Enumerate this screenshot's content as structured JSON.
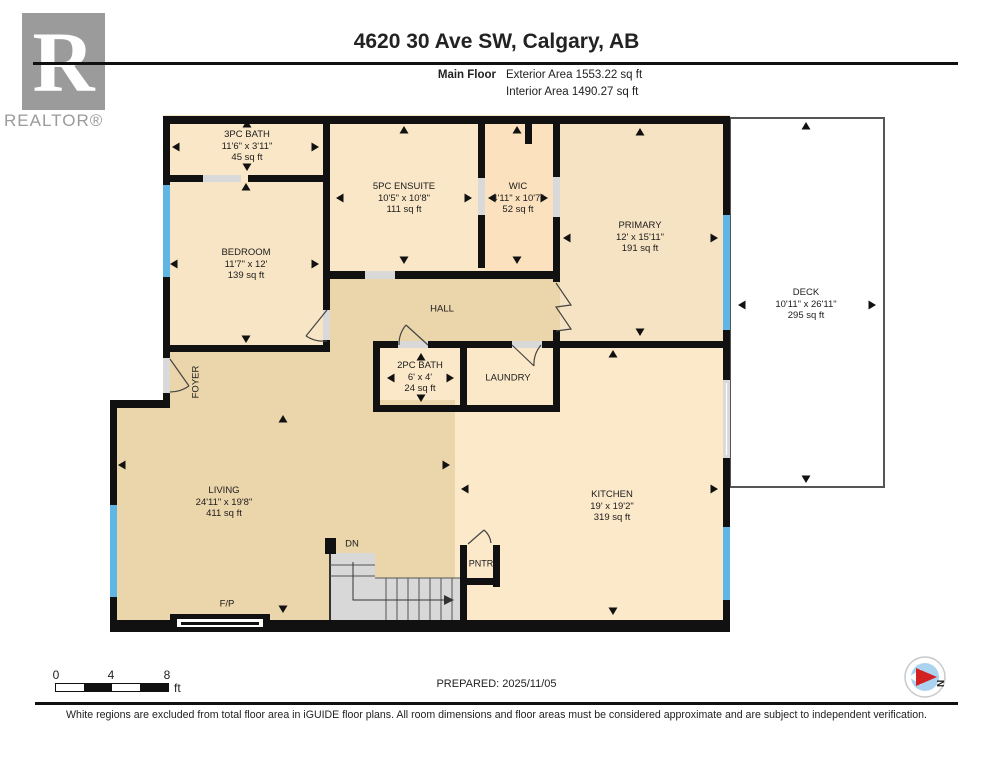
{
  "header": {
    "address": "4620 30 Ave SW, Calgary, AB",
    "floor_label": "Main Floor",
    "exterior_area": "Exterior Area 1553.22 sq ft",
    "interior_area": "Interior Area 1490.27 sq ft"
  },
  "branding": {
    "logo_letter": "R",
    "logo_text": "REALTOR®"
  },
  "rooms": [
    {
      "name": "3PC BATH",
      "dims": "11'6\" x 3'11\"",
      "area": "45 sq ft"
    },
    {
      "name": "5PC ENSUITE",
      "dims": "10'5\" x 10'8\"",
      "area": "111 sq ft"
    },
    {
      "name": "WIC",
      "dims": "4'11\" x 10'7\"",
      "area": "52 sq ft"
    },
    {
      "name": "PRIMARY",
      "dims": "12' x 15'11\"",
      "area": "191 sq ft"
    },
    {
      "name": "BEDROOM",
      "dims": "11'7\" x 12'",
      "area": "139 sq ft"
    },
    {
      "name": "HALL",
      "dims": "",
      "area": ""
    },
    {
      "name": "FOYER",
      "dims": "",
      "area": ""
    },
    {
      "name": "2PC BATH",
      "dims": "6' x 4'",
      "area": "24 sq ft"
    },
    {
      "name": "LAUNDRY",
      "dims": "",
      "area": ""
    },
    {
      "name": "LIVING",
      "dims": "24'11\" x 19'8\"",
      "area": "411 sq ft"
    },
    {
      "name": "KITCHEN",
      "dims": "19' x 19'2\"",
      "area": "319 sq ft"
    },
    {
      "name": "DECK",
      "dims": "10'11\" x 26'11\"",
      "area": "295 sq ft"
    }
  ],
  "annotations": {
    "down": "DN",
    "pantry": "PNTR",
    "fireplace": "F/P"
  },
  "scale_bar": {
    "ticks": [
      "0",
      "4",
      "8"
    ],
    "unit": "ft"
  },
  "compass": {
    "north_label": "N"
  },
  "footer": {
    "prepared": "PREPARED: 2025/11/05",
    "disclaimer": "White regions are excluded from total floor area in iGUIDE floor plans. All room dimensions and floor areas must be considered approximate and are subject to independent verification."
  },
  "colors": {
    "wall": "#111111",
    "window_blue": "#5fb6e5",
    "door_gray": "#d9d9d9",
    "floor_tan": "#ebd5aa",
    "floor_peach": "#fae7c8",
    "stairs_gray": "#d8d8d8",
    "compass_red": "#d42222",
    "compass_blue": "#a9d3ee"
  }
}
